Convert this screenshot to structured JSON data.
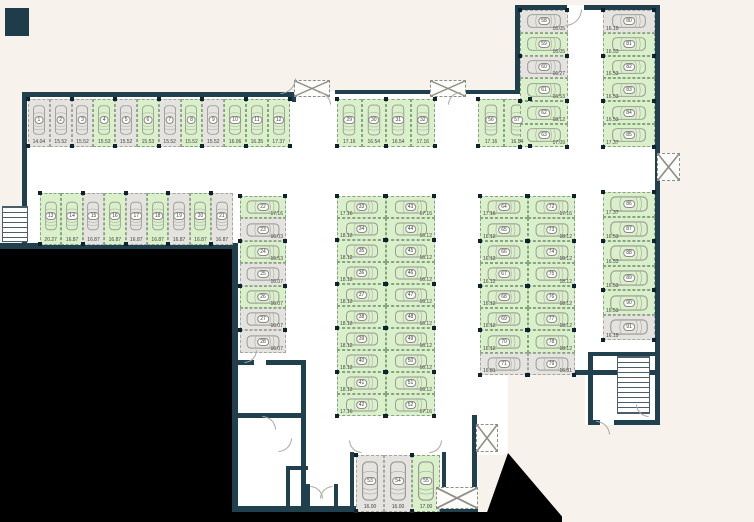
{
  "palette": {
    "wall": "#21404e",
    "available_fill": "#d9f0cb",
    "occupied_fill": "#e4e3df",
    "background": "#f7f3ec",
    "interior": "#ffffff",
    "mask": "#000000",
    "car_outline": "#97978f",
    "text": "#45453f"
  },
  "icons": {
    "car": "car-icon",
    "stairs": "stairs-icon",
    "shaft": "crossed-shaft-icon",
    "door": "door-arc"
  },
  "blocks": [
    {
      "id": "A",
      "spaces": [
        {
          "n": "1",
          "size": "14.04",
          "state": "gray"
        },
        {
          "n": "2",
          "size": "15.52",
          "state": "gray"
        },
        {
          "n": "3",
          "size": "15.52",
          "state": "gray"
        },
        {
          "n": "4",
          "size": "15.53",
          "state": "green"
        },
        {
          "n": "5",
          "size": "15.52",
          "state": "gray"
        },
        {
          "n": "6",
          "size": "15.53",
          "state": "green"
        },
        {
          "n": "7",
          "size": "15.52",
          "state": "gray"
        },
        {
          "n": "8",
          "size": "15.52",
          "state": "green"
        },
        {
          "n": "9",
          "size": "15.52",
          "state": "gray"
        },
        {
          "n": "10",
          "size": "16.06",
          "state": "green"
        },
        {
          "n": "11",
          "size": "16.35",
          "state": "green"
        },
        {
          "n": "12",
          "size": "17.37",
          "state": "green"
        }
      ]
    },
    {
      "id": "B",
      "spaces": [
        {
          "n": "13",
          "size": "20.27",
          "state": "green"
        },
        {
          "n": "14",
          "size": "16.87",
          "state": "green"
        },
        {
          "n": "15",
          "size": "16.87",
          "state": "gray"
        },
        {
          "n": "16",
          "size": "16.87",
          "state": "green"
        },
        {
          "n": "17",
          "size": "16.87",
          "state": "gray"
        },
        {
          "n": "18",
          "size": "16.87",
          "state": "green"
        },
        {
          "n": "19",
          "size": "16.87",
          "state": "gray"
        },
        {
          "n": "20",
          "size": "16.87",
          "state": "green"
        },
        {
          "n": "21",
          "size": "16.87",
          "state": "gray"
        }
      ]
    },
    {
      "id": "C",
      "spaces": [
        {
          "n": "22",
          "size": "17.16",
          "state": "green"
        },
        {
          "n": "23",
          "size": "16.03",
          "state": "gray"
        },
        {
          "n": "24",
          "size": "16.53",
          "state": "green"
        },
        {
          "n": "25",
          "size": "16.07",
          "state": "gray"
        },
        {
          "n": "26",
          "size": "16.07",
          "state": "green"
        },
        {
          "n": "27",
          "size": "16.07",
          "state": "gray"
        },
        {
          "n": "28",
          "size": "16.07",
          "state": "gray"
        }
      ]
    },
    {
      "id": "D",
      "spaces": [
        {
          "n": "29",
          "size": "17.16",
          "state": "green"
        },
        {
          "n": "30",
          "size": "16.54",
          "state": "green"
        },
        {
          "n": "31",
          "size": "16.54",
          "state": "green"
        },
        {
          "n": "32",
          "size": "17.16",
          "state": "green"
        }
      ]
    },
    {
      "id": "E",
      "spaces": [
        {
          "n": "56",
          "size": "17.16",
          "state": "green"
        },
        {
          "n": "57",
          "size": "16.54",
          "state": "green"
        }
      ]
    },
    {
      "id": "F",
      "spaces": [
        {
          "n": "58",
          "size": "16.05",
          "state": "gray"
        },
        {
          "n": "59",
          "size": "16.05",
          "state": "green"
        },
        {
          "n": "60",
          "size": "16.27",
          "state": "gray"
        },
        {
          "n": "61",
          "size": "16.53",
          "state": "green"
        },
        {
          "n": "62",
          "size": "18.12",
          "state": "green"
        },
        {
          "n": "63",
          "size": "17.09",
          "state": "green"
        }
      ]
    },
    {
      "id": "G",
      "spaces": [
        {
          "n": "80",
          "size": "16.19",
          "state": "gray"
        },
        {
          "n": "81",
          "size": "16.53",
          "state": "green"
        },
        {
          "n": "82",
          "size": "16.53",
          "state": "green"
        },
        {
          "n": "83",
          "size": "16.53",
          "state": "green"
        },
        {
          "n": "84",
          "size": "16.53",
          "state": "green"
        },
        {
          "n": "85",
          "size": "17.37",
          "state": "green"
        }
      ]
    },
    {
      "id": "HL",
      "spaces": [
        {
          "n": "33",
          "size": "17.16",
          "state": "green"
        },
        {
          "n": "34",
          "size": "18.12",
          "state": "green"
        },
        {
          "n": "35",
          "size": "18.12",
          "state": "green"
        },
        {
          "n": "36",
          "size": "18.12",
          "state": "green"
        },
        {
          "n": "37",
          "size": "18.12",
          "state": "green"
        },
        {
          "n": "38",
          "size": "18.12",
          "state": "green"
        },
        {
          "n": "39",
          "size": "18.12",
          "state": "green"
        },
        {
          "n": "40",
          "size": "18.12",
          "state": "green"
        },
        {
          "n": "41",
          "size": "18.12",
          "state": "green"
        },
        {
          "n": "42",
          "size": "17.16",
          "state": "green"
        }
      ]
    },
    {
      "id": "HR",
      "spaces": [
        {
          "n": "43",
          "size": "17.16",
          "state": "green"
        },
        {
          "n": "44",
          "size": "16.12",
          "state": "green"
        },
        {
          "n": "45",
          "size": "16.12",
          "state": "green"
        },
        {
          "n": "46",
          "size": "16.12",
          "state": "green"
        },
        {
          "n": "47",
          "size": "16.12",
          "state": "green"
        },
        {
          "n": "48",
          "size": "16.12",
          "state": "green"
        },
        {
          "n": "49",
          "size": "16.12",
          "state": "green"
        },
        {
          "n": "50",
          "size": "16.12",
          "state": "green"
        },
        {
          "n": "51",
          "size": "16.12",
          "state": "green"
        },
        {
          "n": "52",
          "size": "17.16",
          "state": "green"
        }
      ]
    },
    {
      "id": "IL",
      "spaces": [
        {
          "n": "64",
          "size": "17.16",
          "state": "green"
        },
        {
          "n": "65",
          "size": "16.12",
          "state": "green"
        },
        {
          "n": "66",
          "size": "16.12",
          "state": "green"
        },
        {
          "n": "67",
          "size": "16.12",
          "state": "green"
        },
        {
          "n": "68",
          "size": "16.12",
          "state": "green"
        },
        {
          "n": "69",
          "size": "16.12",
          "state": "green"
        },
        {
          "n": "70",
          "size": "16.12",
          "state": "green"
        },
        {
          "n": "71",
          "size": "16.81",
          "state": "gray"
        }
      ]
    },
    {
      "id": "IR",
      "spaces": [
        {
          "n": "72",
          "size": "17.16",
          "state": "green"
        },
        {
          "n": "73",
          "size": "18.12",
          "state": "green"
        },
        {
          "n": "74",
          "size": "18.12",
          "state": "green"
        },
        {
          "n": "75",
          "size": "18.12",
          "state": "green"
        },
        {
          "n": "76",
          "size": "18.12",
          "state": "green"
        },
        {
          "n": "77",
          "size": "18.12",
          "state": "green"
        },
        {
          "n": "78",
          "size": "18.12",
          "state": "green"
        },
        {
          "n": "79",
          "size": "16.81",
          "state": "gray"
        }
      ]
    },
    {
      "id": "J",
      "spaces": [
        {
          "n": "86",
          "size": "17.37",
          "state": "green"
        },
        {
          "n": "87",
          "size": "16.53",
          "state": "green"
        },
        {
          "n": "88",
          "size": "16.53",
          "state": "green"
        },
        {
          "n": "89",
          "size": "16.53",
          "state": "green"
        },
        {
          "n": "90",
          "size": "16.53",
          "state": "green"
        },
        {
          "n": "91",
          "size": "16.19",
          "state": "gray"
        }
      ]
    },
    {
      "id": "K",
      "spaces": [
        {
          "n": "53",
          "size": "16.00",
          "state": "gray"
        },
        {
          "n": "54",
          "size": "16.00",
          "state": "gray"
        },
        {
          "n": "55",
          "size": "17.00",
          "state": "green"
        }
      ]
    }
  ]
}
